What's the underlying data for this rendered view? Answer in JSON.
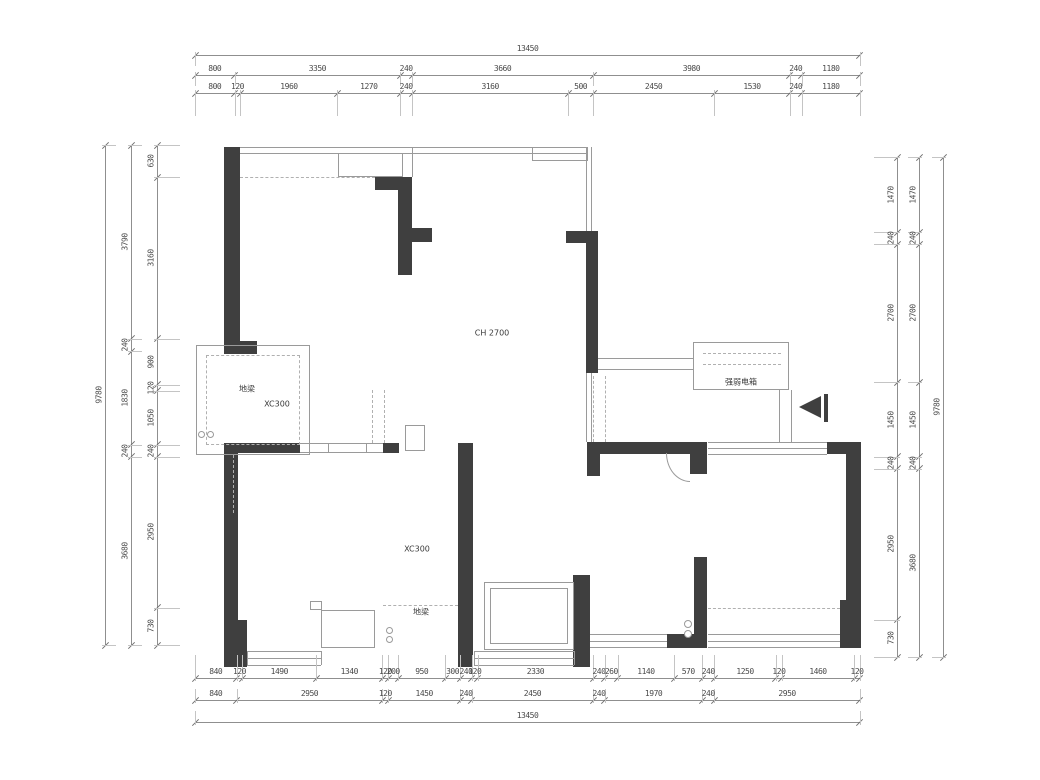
{
  "drawing": {
    "type": "floor-plan",
    "colors": {
      "wall": "#3f3f3f",
      "thin_line": "#9a9a9a",
      "dim_line": "#8f8f8f",
      "dim_text": "#4a4a4a",
      "background": "#ffffff"
    },
    "ceiling_height_label": "CH 2700",
    "labels": [
      {
        "text": "CH 2700",
        "x": 492,
        "y": 333
      },
      {
        "text": "地梁",
        "x": 247,
        "y": 389
      },
      {
        "text": "XC300",
        "x": 277,
        "y": 404
      },
      {
        "text": "XC300",
        "x": 417,
        "y": 549
      },
      {
        "text": "地梁",
        "x": 421,
        "y": 612
      },
      {
        "text": "强弱电箱",
        "x": 741,
        "y": 382
      }
    ]
  },
  "dimensions": {
    "overall_width_mm": "13450",
    "overall_height_mm": "9780",
    "chains": [
      {
        "name": "top-total",
        "orient": "h",
        "line": 55,
        "start": 195,
        "scale": 0.049442,
        "ext": 14,
        "dir": 1,
        "segs": [
          "13450"
        ]
      },
      {
        "name": "top-outer",
        "orient": "h",
        "line": 75,
        "start": 195,
        "scale": 0.049442,
        "ext": 14,
        "dir": 1,
        "segs": [
          "800",
          "3350",
          "240",
          "3660",
          "3980",
          "240",
          "1180"
        ]
      },
      {
        "name": "top-inner",
        "orient": "h",
        "line": 93,
        "start": 195,
        "scale": 0.049442,
        "ext": 26,
        "dir": 1,
        "segs": [
          "800",
          "120",
          "1960",
          "1270",
          "240",
          "3160",
          "500",
          "2450",
          "1530",
          "240",
          "1180"
        ]
      },
      {
        "name": "bottom-inner",
        "orient": "h",
        "line": 678,
        "start": 195,
        "scale": 0.049442,
        "ext": 26,
        "dir": -1,
        "segs": [
          "840",
          "120",
          "1490",
          "1340",
          "120",
          "200",
          "950",
          "300",
          "240",
          "120",
          "2330",
          "240",
          "260",
          "1140",
          "570",
          "240",
          "1250",
          "120",
          "1460",
          "120"
        ]
      },
      {
        "name": "bottom-outer",
        "orient": "h",
        "line": 700,
        "start": 195,
        "scale": 0.049442,
        "ext": 14,
        "dir": -1,
        "segs": [
          "840",
          "2950",
          "120",
          "1450",
          "240",
          "2450",
          "240",
          "1970",
          "240",
          "2950"
        ]
      },
      {
        "name": "bottom-total",
        "orient": "h",
        "line": 722,
        "start": 195,
        "scale": 0.049442,
        "ext": 14,
        "dir": -1,
        "segs": [
          "13450"
        ]
      },
      {
        "name": "left-total",
        "orient": "v",
        "line": 105,
        "start": 145,
        "scale": 0.051125,
        "ext": 14,
        "dir": 1,
        "segs": [
          "9780"
        ]
      },
      {
        "name": "left-outer",
        "orient": "v",
        "line": 131,
        "start": 145,
        "scale": 0.051125,
        "ext": 14,
        "dir": 1,
        "segs": [
          "3790",
          "240",
          "1830",
          "240",
          "3680"
        ]
      },
      {
        "name": "left-inner",
        "orient": "v",
        "line": 157,
        "start": 145,
        "scale": 0.051125,
        "ext": 26,
        "dir": 1,
        "segs": [
          "630",
          "3160",
          "900",
          "120",
          "1050",
          "240",
          "2950",
          "730"
        ]
      },
      {
        "name": "right-inner",
        "orient": "v",
        "line": 897,
        "start": 157,
        "scale": 0.051125,
        "ext": 26,
        "dir": -1,
        "segs": [
          "1470",
          "240",
          "2700",
          "1450",
          "240",
          "2950",
          "730"
        ]
      },
      {
        "name": "right-outer",
        "orient": "v",
        "line": 919,
        "start": 157,
        "scale": 0.051125,
        "ext": 14,
        "dir": -1,
        "segs": [
          "1470",
          "240",
          "2700",
          "1450",
          "240",
          "3680"
        ]
      },
      {
        "name": "right-total",
        "orient": "v",
        "line": 943,
        "start": 157,
        "scale": 0.051125,
        "ext": 14,
        "dir": -1,
        "segs": [
          "9780"
        ]
      }
    ]
  },
  "plan": {
    "walls": [
      [
        224,
        147,
        16,
        207
      ],
      [
        224,
        341,
        33,
        13
      ],
      [
        375,
        177,
        37,
        13
      ],
      [
        398,
        177,
        14,
        98
      ],
      [
        412,
        228,
        20,
        14
      ],
      [
        566,
        231,
        32,
        12
      ],
      [
        586,
        231,
        12,
        142
      ],
      [
        224,
        443,
        14,
        224
      ],
      [
        224,
        620,
        23,
        47
      ],
      [
        238,
        443,
        62,
        10
      ],
      [
        383,
        443,
        16,
        10
      ],
      [
        458,
        443,
        15,
        224
      ],
      [
        587,
        442,
        120,
        12
      ],
      [
        587,
        454,
        13,
        22
      ],
      [
        690,
        442,
        17,
        32
      ],
      [
        694,
        557,
        13,
        91
      ],
      [
        667,
        634,
        27,
        14
      ],
      [
        573,
        575,
        17,
        92
      ],
      [
        827,
        442,
        33,
        12
      ],
      [
        846,
        442,
        15,
        160
      ],
      [
        840,
        600,
        21,
        48
      ],
      [
        824,
        394,
        4,
        28
      ]
    ],
    "lines": [
      [
        240,
        147,
        346,
        1
      ],
      [
        240,
        153,
        346,
        1
      ],
      [
        586,
        147,
        1,
        84
      ],
      [
        591,
        147,
        1,
        84
      ],
      [
        586,
        373,
        1,
        69
      ],
      [
        591,
        373,
        1,
        69
      ],
      [
        598,
        358,
        95,
        1
      ],
      [
        598,
        369,
        95,
        1
      ],
      [
        708,
        442,
        119,
        1
      ],
      [
        708,
        448,
        119,
        1
      ],
      [
        708,
        454,
        119,
        1
      ],
      [
        300,
        443,
        83,
        1
      ],
      [
        300,
        452,
        83,
        1
      ],
      [
        247,
        651,
        74,
        1
      ],
      [
        247,
        658,
        74,
        1
      ],
      [
        247,
        665,
        74,
        1
      ],
      [
        474,
        651,
        100,
        1
      ],
      [
        474,
        658,
        100,
        1
      ],
      [
        474,
        665,
        100,
        1
      ],
      [
        590,
        634,
        77,
        1
      ],
      [
        590,
        641,
        77,
        1
      ],
      [
        590,
        647,
        77,
        1
      ],
      [
        708,
        634,
        132,
        1
      ],
      [
        708,
        641,
        132,
        1
      ],
      [
        708,
        647,
        132,
        1
      ],
      [
        321,
        651,
        1,
        14
      ],
      [
        247,
        651,
        1,
        14
      ],
      [
        474,
        651,
        1,
        14
      ],
      [
        574,
        651,
        1,
        14
      ],
      [
        779,
        390,
        1,
        52
      ],
      [
        791,
        390,
        1,
        52
      ],
      [
        412,
        147,
        1,
        30
      ]
    ],
    "boxes": [
      {
        "x": 338,
        "y": 153,
        "w": 65,
        "h": 24
      },
      {
        "x": 532,
        "y": 147,
        "w": 56,
        "h": 14
      },
      {
        "x": 196,
        "y": 345,
        "w": 114,
        "h": 110
      },
      {
        "x": 206,
        "y": 355,
        "w": 94,
        "h": 90,
        "dashed": true
      },
      {
        "x": 321,
        "y": 610,
        "w": 54,
        "h": 38
      },
      {
        "x": 310,
        "y": 601,
        "w": 12,
        "h": 9
      },
      {
        "x": 484,
        "y": 582,
        "w": 90,
        "h": 68
      },
      {
        "x": 490,
        "y": 588,
        "w": 78,
        "h": 56
      },
      {
        "x": 405,
        "y": 425,
        "w": 20,
        "h": 26
      },
      {
        "x": 693,
        "y": 342,
        "w": 96,
        "h": 48
      },
      {
        "x": 328,
        "y": 443,
        "w": 39,
        "h": 10
      }
    ],
    "dashes": [
      {
        "x": 240,
        "y": 177,
        "len": 135,
        "o": "h"
      },
      {
        "x": 383,
        "y": 605,
        "len": 75,
        "o": "h"
      },
      {
        "x": 708,
        "y": 608,
        "len": 132,
        "o": "h"
      },
      {
        "x": 703,
        "y": 353,
        "len": 78,
        "o": "h"
      },
      {
        "x": 703,
        "y": 364,
        "len": 78,
        "o": "h"
      },
      {
        "x": 372,
        "y": 390,
        "len": 53,
        "o": "v"
      },
      {
        "x": 384,
        "y": 390,
        "len": 53,
        "o": "v"
      },
      {
        "x": 593,
        "y": 376,
        "len": 66,
        "o": "v"
      },
      {
        "x": 605,
        "y": 376,
        "len": 66,
        "o": "v"
      },
      {
        "x": 233,
        "y": 455,
        "len": 58,
        "o": "v"
      }
    ],
    "circles": [
      {
        "x": 684,
        "y": 620,
        "d": 8
      },
      {
        "x": 684,
        "y": 630,
        "d": 8
      },
      {
        "x": 386,
        "y": 627,
        "d": 7
      },
      {
        "x": 386,
        "y": 636,
        "d": 7
      },
      {
        "x": 198,
        "y": 431,
        "d": 7
      },
      {
        "x": 207,
        "y": 431,
        "d": 7
      }
    ],
    "arcs": [
      {
        "x": 666,
        "y": 453,
        "w": 24,
        "h": 29
      }
    ],
    "entry_arrow": {
      "x": 799,
      "y": 396
    }
  }
}
